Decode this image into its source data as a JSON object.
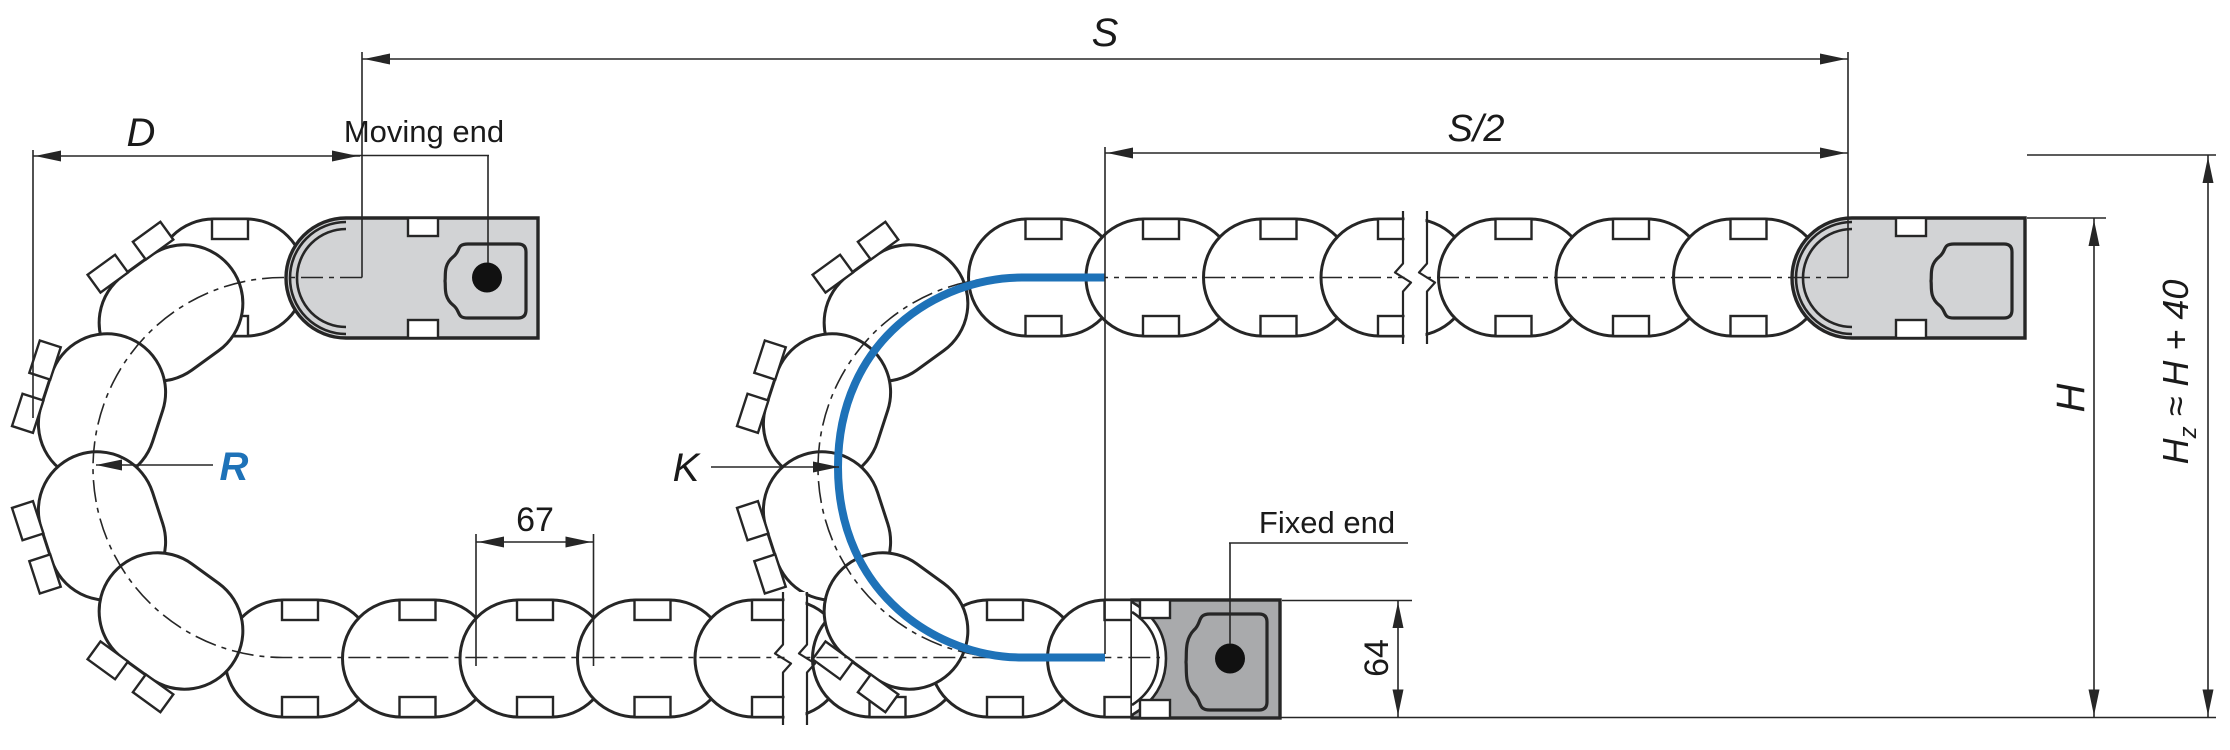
{
  "drawing": {
    "dims": {
      "s": "S",
      "s_half": "S/2",
      "d": "D",
      "pitch": "67",
      "link_height": "64",
      "h": "H"
    },
    "hz": {
      "base": "H",
      "sub": "z",
      "rest": " ≈ H + 40"
    },
    "annotations": {
      "moving_end": "Moving end",
      "fixed_end": "Fixed end",
      "radius": "R",
      "k_curve": "K"
    },
    "colors": {
      "accent_blue": "#1e72b8",
      "line": "#262626",
      "moving_block_gray": "#d2d3d5",
      "fixed_block_gray": "#a9aaac",
      "background": "#ffffff"
    }
  }
}
